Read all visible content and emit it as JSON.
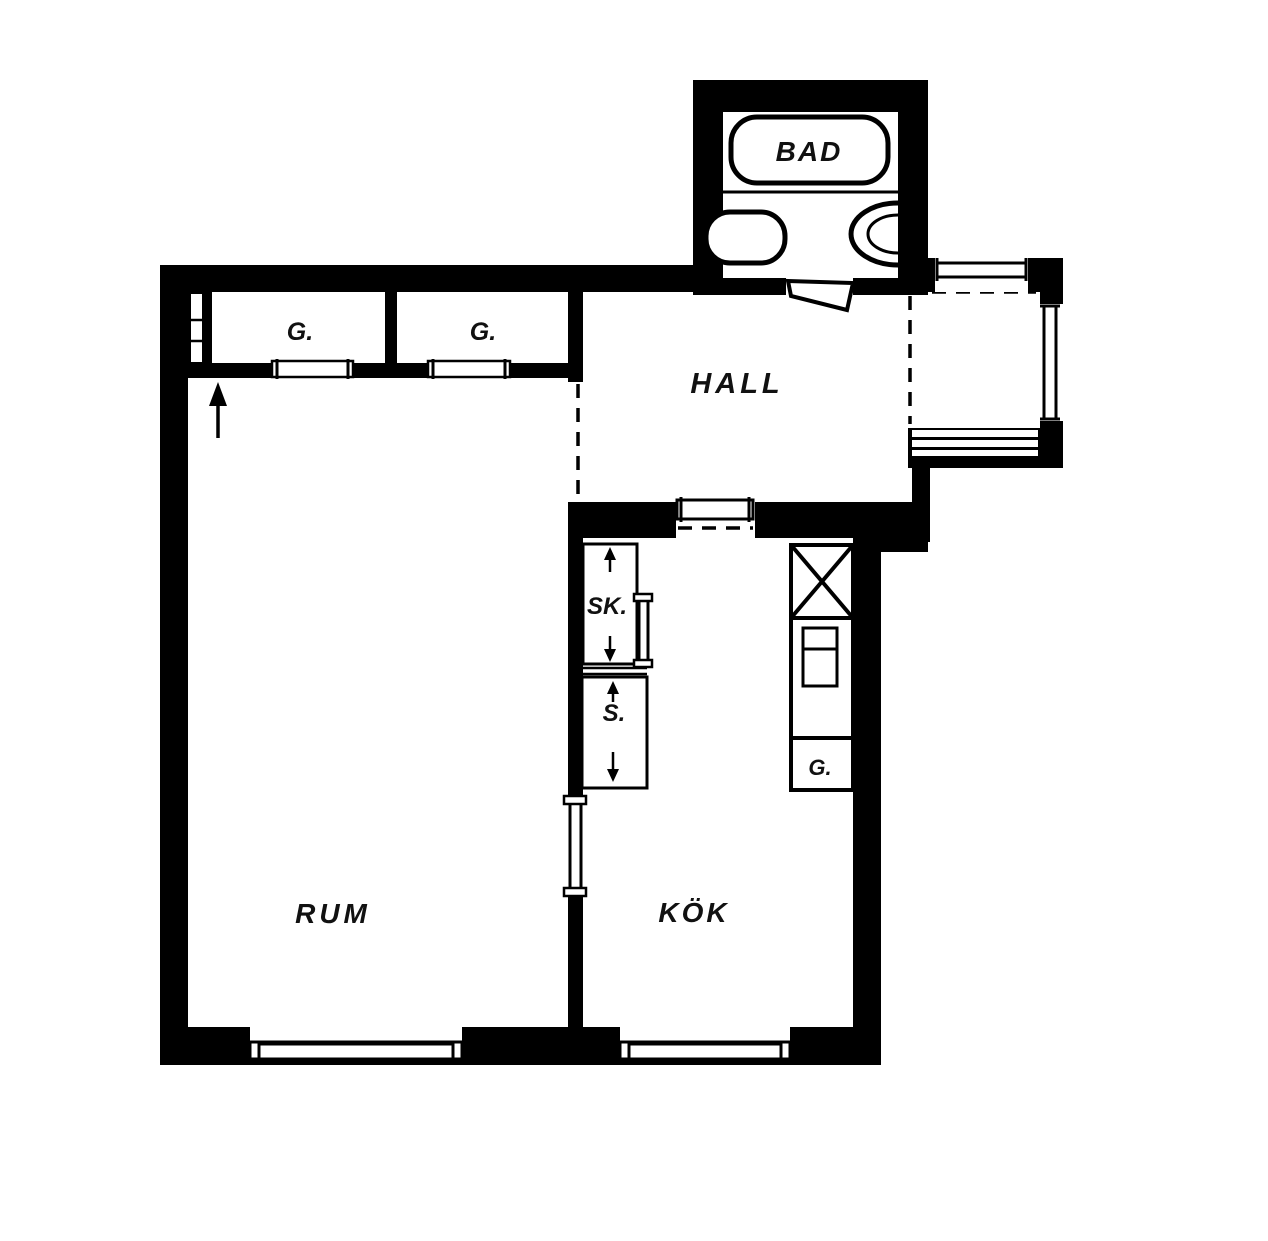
{
  "plan": {
    "type": "apartment-floor-plan",
    "rooms": {
      "bathroom": "BAD",
      "hall": "HALL",
      "room": "RUM",
      "kitchen": "KÖK"
    },
    "closets": {
      "closet_1": "G.",
      "closet_2": "G.",
      "closet_sk": "SK.",
      "closet_s": "S.",
      "kitchen_cabinet": "G."
    },
    "symbols": [
      "entry-arrow-icon",
      "bathtub-icon",
      "toilet-icon",
      "sink-icon",
      "refrigerator-cross-icon",
      "stove-icon",
      "window-icon",
      "sliding-door-icon",
      "door-swing-icon"
    ],
    "colors": {
      "walls": "#000000",
      "background": "#ffffff",
      "floor": "#ffffff"
    }
  }
}
